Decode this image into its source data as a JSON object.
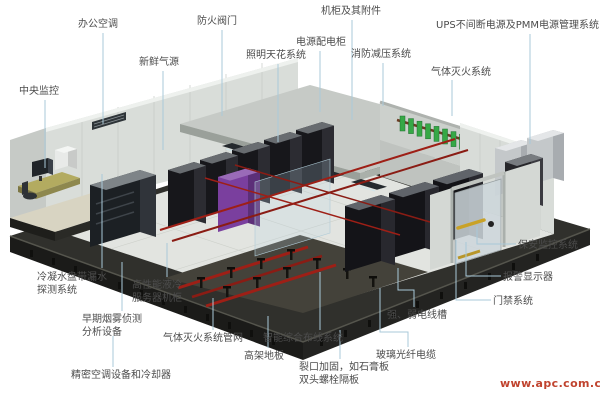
{
  "diagram_title": "数据中心机房系统示意图",
  "labels": [
    {
      "id": "office-ac",
      "text": "办公空调",
      "x": 78,
      "y": 18
    },
    {
      "id": "fire-damper",
      "text": "防火阀门",
      "x": 197,
      "y": 15
    },
    {
      "id": "fresh-air",
      "text": "新鲜气源",
      "x": 139,
      "y": 56
    },
    {
      "id": "lighting-ceiling",
      "text": "照明天花系统",
      "x": 246,
      "y": 49
    },
    {
      "id": "cabinet-accessories",
      "text": "机柜及其附件",
      "x": 321,
      "y": 5
    },
    {
      "id": "power-distribution-cabinet",
      "text": "电源配电柜",
      "x": 296,
      "y": 36
    },
    {
      "id": "ups-pmm-power",
      "text": "UPS不间断电源及PMM电源管理系统",
      "x": 436,
      "y": 19
    },
    {
      "id": "fire-pressure-relief",
      "text": "消防减压系统",
      "x": 351,
      "y": 48
    },
    {
      "id": "gas-fire-suppression",
      "text": "气体灭火系统",
      "x": 431,
      "y": 66
    },
    {
      "id": "central-monitoring",
      "text": "中央监控",
      "x": 19,
      "y": 85
    },
    {
      "id": "condensate-leak-detection",
      "text": "冷凝水盘带漏水\n探测系统",
      "x": 37,
      "y": 271
    },
    {
      "id": "liquid-cooled-server-rack",
      "text": "高性能液冷\n服务器机柜",
      "x": 132,
      "y": 279
    },
    {
      "id": "early-smoke-detection",
      "text": "早期烟雾侦测\n分析设备",
      "x": 82,
      "y": 313
    },
    {
      "id": "gas-suppression-piping",
      "text": "气体灭火系统管网",
      "x": 163,
      "y": 332
    },
    {
      "id": "intelligent-cabling",
      "text": "智能综合布线系统",
      "x": 263,
      "y": 332
    },
    {
      "id": "raised-floor",
      "text": "高架地板",
      "x": 244,
      "y": 350
    },
    {
      "id": "precision-ac-cooler",
      "text": "精密空调设备和冷却器",
      "x": 71,
      "y": 369
    },
    {
      "id": "crack-reinforcement",
      "text": "裂口加固，如石膏板\n双头螺栓隔板",
      "x": 299,
      "y": 361
    },
    {
      "id": "fiber-optic-cable",
      "text": "玻璃光纤电缆",
      "x": 376,
      "y": 349
    },
    {
      "id": "cable-trough",
      "text": "强、弱电线槽",
      "x": 387,
      "y": 309
    },
    {
      "id": "access-control",
      "text": "门禁系统",
      "x": 493,
      "y": 295
    },
    {
      "id": "alarm-display",
      "text": "报警显示器",
      "x": 503,
      "y": 271
    },
    {
      "id": "security-monitoring",
      "text": "保安监控系统",
      "x": 518,
      "y": 239
    }
  ],
  "watermark": {
    "text": "www.apc.com.cn"
  },
  "colors": {
    "label_text": "#4c4c4c",
    "leader_line": "#a9c9d9",
    "watermark": "#c0432e",
    "rack_purple": "#7a3f9e",
    "cylinder_green": "#36a846",
    "cable_tray_red": "#9e1f16"
  }
}
